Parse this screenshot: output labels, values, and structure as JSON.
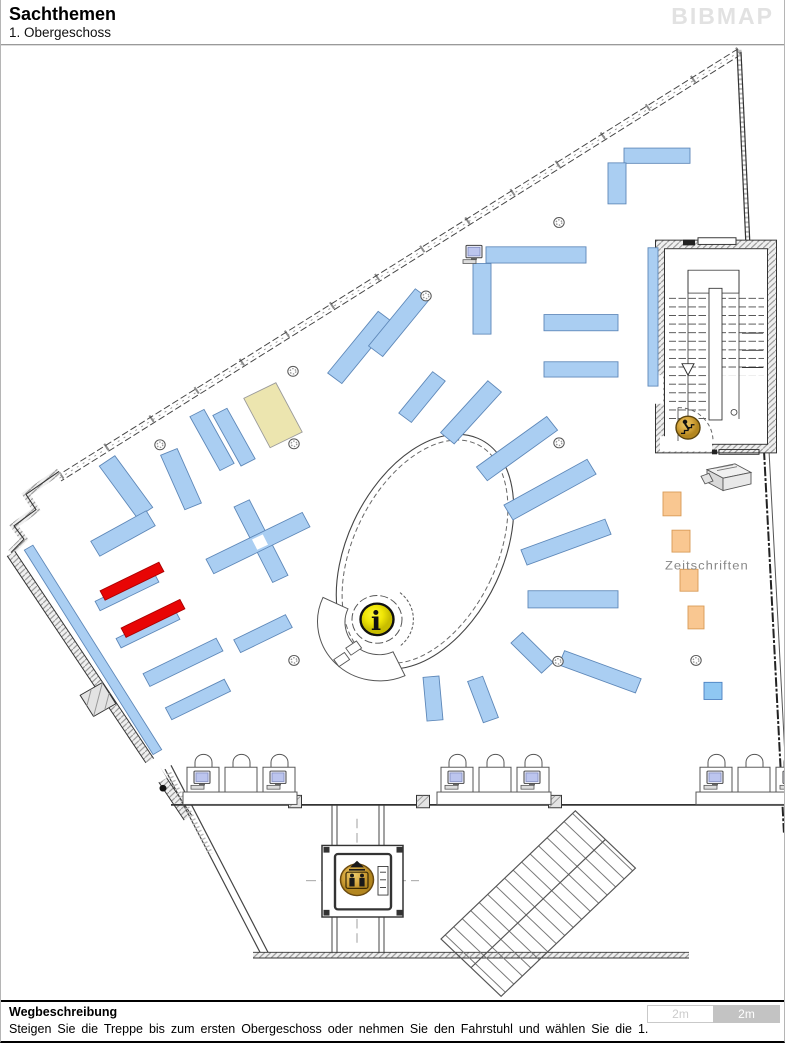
{
  "header": {
    "title": "Sachthemen",
    "subtitle": "1. Obergeschoss",
    "logo": "BIBMAP"
  },
  "footer": {
    "heading": "Wegbeschreibung",
    "description": "Steigen Sie die Treppe bis zum ersten Obergeschoss oder nehmen Sie den Fahrstuhl und wählen Sie die 1.",
    "scale_left": "2m",
    "scale_right": "2m"
  },
  "map": {
    "zeitschriften_label": "Zeitschriften",
    "info_symbol": "i",
    "colors": {
      "blue": "#aacef2",
      "blue_border": "#5d87b8",
      "sky": "#8fc7f2",
      "sky_border": "#4a7fc0",
      "red": "#e80505",
      "red_border": "#a80000",
      "beige": "#ece5af",
      "beige_border": "#9a9a9a",
      "orange": "#f9c791",
      "orange_border": "#d89a55"
    },
    "shelves": [
      {
        "x": 656,
        "y": 161,
        "l": 66,
        "w": 16,
        "a": 0,
        "c": "blue"
      },
      {
        "x": 616,
        "y": 190,
        "l": 43,
        "w": 18,
        "a": 90,
        "c": "blue"
      },
      {
        "x": 535,
        "y": 265,
        "l": 100,
        "w": 17,
        "a": 0,
        "c": "blue"
      },
      {
        "x": 481,
        "y": 311,
        "l": 74,
        "w": 18,
        "a": 90,
        "c": "blue"
      },
      {
        "x": 580,
        "y": 336,
        "l": 74,
        "w": 17,
        "a": 0,
        "c": "blue"
      },
      {
        "x": 580,
        "y": 385,
        "l": 74,
        "w": 16,
        "a": 0,
        "c": "blue"
      },
      {
        "x": 652,
        "y": 330,
        "l": 145,
        "w": 10,
        "a": 90,
        "c": "blue"
      },
      {
        "x": 359,
        "y": 362,
        "l": 82,
        "w": 18,
        "a": -52,
        "c": "blue"
      },
      {
        "x": 398,
        "y": 336,
        "l": 76,
        "w": 18,
        "a": -52,
        "c": "blue"
      },
      {
        "x": 421,
        "y": 414,
        "l": 55,
        "w": 16,
        "a": -52,
        "c": "blue"
      },
      {
        "x": 470,
        "y": 430,
        "l": 72,
        "w": 18,
        "a": -49,
        "c": "blue"
      },
      {
        "x": 516,
        "y": 468,
        "l": 88,
        "w": 18,
        "a": -37,
        "c": "blue"
      },
      {
        "x": 549,
        "y": 511,
        "l": 96,
        "w": 18,
        "a": -30,
        "c": "blue"
      },
      {
        "x": 565,
        "y": 566,
        "l": 90,
        "w": 17,
        "a": -21,
        "c": "blue"
      },
      {
        "x": 572,
        "y": 626,
        "l": 90,
        "w": 18,
        "a": 0,
        "c": "blue"
      },
      {
        "x": 531,
        "y": 682,
        "l": 44,
        "w": 16,
        "a": 46,
        "c": "blue"
      },
      {
        "x": 599,
        "y": 702,
        "l": 82,
        "w": 16,
        "a": 21,
        "c": "blue"
      },
      {
        "x": 432,
        "y": 730,
        "l": 46,
        "w": 16,
        "a": 85,
        "c": "blue"
      },
      {
        "x": 482,
        "y": 731,
        "l": 46,
        "w": 16,
        "a": 70,
        "c": "blue"
      },
      {
        "x": 125,
        "y": 508,
        "l": 66,
        "w": 19,
        "a": 55,
        "c": "blue"
      },
      {
        "x": 122,
        "y": 557,
        "l": 64,
        "w": 18,
        "a": -30,
        "c": "blue"
      },
      {
        "x": 180,
        "y": 500,
        "l": 62,
        "w": 18,
        "a": 67,
        "c": "blue"
      },
      {
        "x": 211,
        "y": 459,
        "l": 64,
        "w": 16,
        "a": 62,
        "c": "blue"
      },
      {
        "x": 233,
        "y": 456,
        "l": 60,
        "w": 16,
        "a": 62,
        "c": "blue"
      },
      {
        "x": 260,
        "y": 565,
        "l": 88,
        "w": 17,
        "a": 64,
        "c": "blue"
      },
      {
        "x": 257,
        "y": 567,
        "l": 108,
        "w": 17,
        "a": -27,
        "c": "blue"
      },
      {
        "x": 126,
        "y": 618,
        "l": 66,
        "w": 11,
        "a": -27,
        "c": "blue"
      },
      {
        "x": 147,
        "y": 657,
        "l": 66,
        "w": 11,
        "a": -27,
        "c": "blue"
      },
      {
        "x": 182,
        "y": 692,
        "l": 82,
        "w": 15,
        "a": -27,
        "c": "blue"
      },
      {
        "x": 197,
        "y": 731,
        "l": 66,
        "w": 14,
        "a": -27,
        "c": "blue"
      },
      {
        "x": 262,
        "y": 662,
        "l": 58,
        "w": 15,
        "a": -27,
        "c": "blue"
      },
      {
        "x": 92,
        "y": 679,
        "l": 250,
        "w": 10,
        "a": 59,
        "c": "blue"
      },
      {
        "x": 712,
        "y": 722,
        "l": 18,
        "w": 18,
        "a": 0,
        "c": "sky"
      },
      {
        "x": 131,
        "y": 607,
        "l": 66,
        "w": 11,
        "a": -27,
        "c": "red"
      },
      {
        "x": 152,
        "y": 646,
        "l": 66,
        "w": 11,
        "a": -27,
        "c": "red"
      },
      {
        "x": 272,
        "y": 433,
        "l": 58,
        "w": 36,
        "a": 63,
        "c": "beige"
      },
      {
        "x": 671,
        "y": 526,
        "l": 25,
        "w": 18,
        "a": 90,
        "c": "orange"
      },
      {
        "x": 680,
        "y": 565,
        "l": 23,
        "w": 18,
        "a": 90,
        "c": "orange"
      },
      {
        "x": 688,
        "y": 606,
        "l": 23,
        "w": 18,
        "a": 90,
        "c": "orange"
      },
      {
        "x": 695,
        "y": 645,
        "l": 24,
        "w": 16,
        "a": 90,
        "c": "orange"
      }
    ],
    "cross_gap": {
      "x": 259,
      "y": 566,
      "s": 12,
      "a": 64
    },
    "columns": [
      [
        558,
        231
      ],
      [
        425,
        308
      ],
      [
        292,
        387
      ],
      [
        159,
        464
      ],
      [
        293,
        463
      ],
      [
        558,
        462
      ],
      [
        557,
        691
      ],
      [
        293,
        690
      ],
      [
        695,
        690
      ]
    ],
    "wall_pillars": [
      [
        294,
        838
      ],
      [
        422,
        838
      ],
      [
        554,
        838
      ]
    ],
    "computer_stations": [
      {
        "x": 186
      },
      {
        "x": 440
      },
      {
        "x": 699
      }
    ],
    "single_computer": {
      "x": 473,
      "y": 271
    }
  }
}
